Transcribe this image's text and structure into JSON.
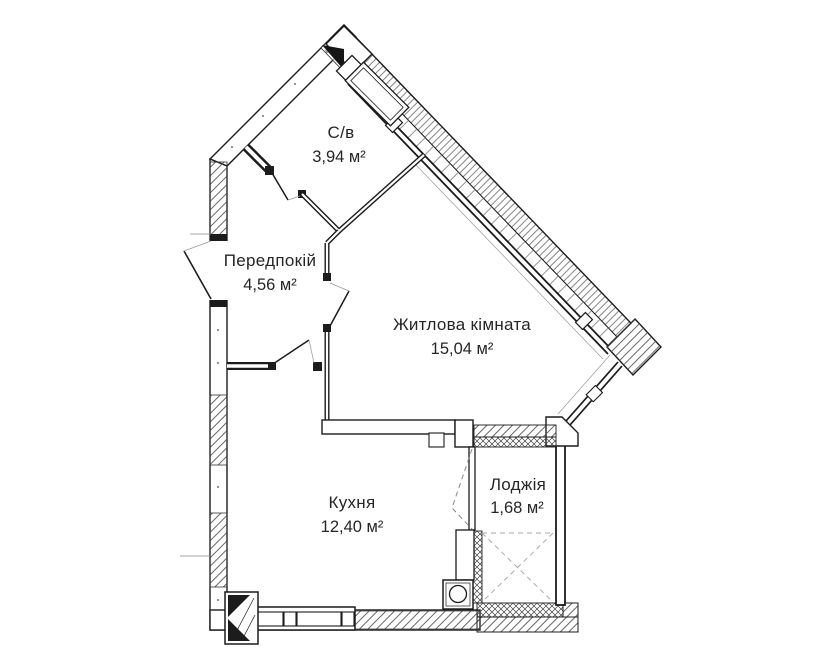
{
  "plan": {
    "type": "apartment-floor-plan",
    "rooms": [
      {
        "id": "bathroom",
        "name": "С/в",
        "area": "3,94 м²"
      },
      {
        "id": "hallway",
        "name": "Передпокій",
        "area": "4,56 м²"
      },
      {
        "id": "living",
        "name": "Житлова кімната",
        "area": "15,04 м²"
      },
      {
        "id": "kitchen",
        "name": "Кухня",
        "area": "12,40 м²"
      },
      {
        "id": "loggia",
        "name": "Лоджія",
        "area": "1,68 м²"
      }
    ],
    "colors": {
      "line": "#1c1c1c",
      "hatch": "#555555",
      "dashed": "#9a9a9a",
      "background": "#ffffff"
    }
  }
}
